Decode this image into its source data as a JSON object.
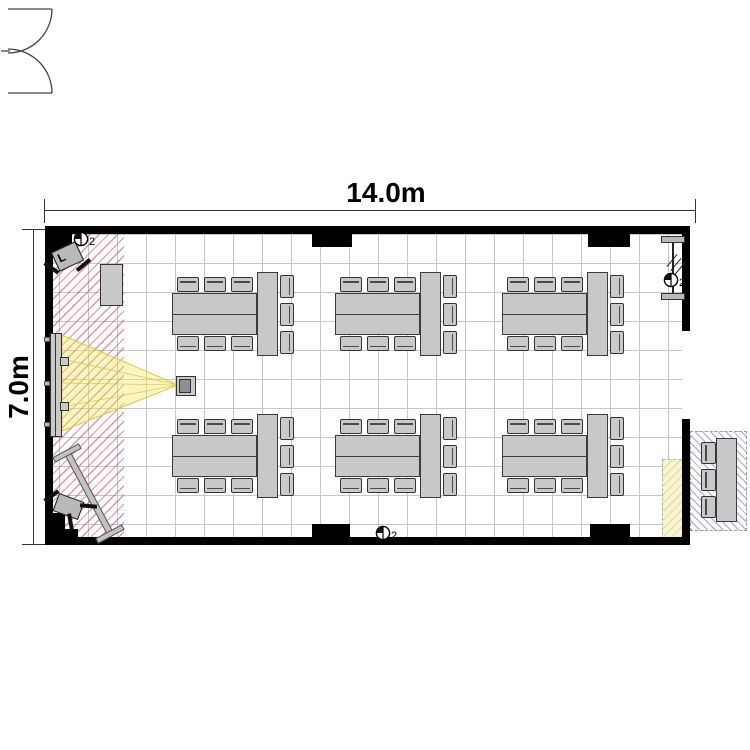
{
  "dimensions": {
    "width_label": "14.0m",
    "height_label": "7.0m"
  },
  "symbols": {
    "fixture_count_label": "2",
    "speaker_label": "L",
    "instances": [
      {
        "name": "ceiling-fixture-symbol-top-left",
        "x": 73,
        "y": 231
      },
      {
        "name": "ceiling-fixture-symbol-top-right",
        "x": 663,
        "y": 272
      },
      {
        "name": "ceiling-fixture-symbol-bottom-center",
        "x": 375,
        "y": 525
      }
    ]
  },
  "colors": {
    "wall": "#000000",
    "grid": "#c7c7c7",
    "furniture_fill": "#c8c8ca",
    "hatch_pink": "#c73e62",
    "hatch_blue": "#6e73aa",
    "beam_yellow": "#f4e45a",
    "zone_yellow": "#f7f4d4"
  },
  "plan": {
    "grid_area": {
      "x": 53,
      "y": 234,
      "w": 629,
      "h": 303
    },
    "walls": [
      {
        "name": "wall-top",
        "x": 45,
        "y": 226,
        "w": 645,
        "h": 8
      },
      {
        "name": "wall-bottom",
        "x": 45,
        "y": 537,
        "w": 645,
        "h": 8
      },
      {
        "name": "wall-left",
        "x": 45,
        "y": 226,
        "w": 8,
        "h": 319
      },
      {
        "name": "wall-right-upper",
        "x": 682,
        "y": 226,
        "w": 8,
        "h": 105
      },
      {
        "name": "wall-right-lower",
        "x": 682,
        "y": 419,
        "w": 8,
        "h": 126
      }
    ],
    "wall_blocks": [
      {
        "name": "column-top-left",
        "x": 45,
        "y": 226,
        "w": 27,
        "h": 26
      },
      {
        "name": "column-top-center",
        "x": 312,
        "y": 226,
        "w": 40,
        "h": 21
      },
      {
        "name": "column-top-right",
        "x": 588,
        "y": 226,
        "w": 42,
        "h": 21
      },
      {
        "name": "column-bottom-left-a",
        "x": 45,
        "y": 513,
        "w": 20,
        "h": 32
      },
      {
        "name": "column-bottom-left-b",
        "x": 45,
        "y": 529,
        "w": 33,
        "h": 16
      },
      {
        "name": "column-bottom-center",
        "x": 312,
        "y": 524,
        "w": 38,
        "h": 21
      },
      {
        "name": "column-bottom-right",
        "x": 590,
        "y": 524,
        "w": 40,
        "h": 21
      }
    ],
    "zones": {
      "presentation_hatch": {
        "x": 53,
        "y": 234,
        "w": 71,
        "h": 303
      },
      "equipment_yellow": {
        "x": 662,
        "y": 459,
        "w": 23,
        "h": 84
      },
      "outside_hatch": {
        "x": 690,
        "y": 431,
        "w": 55,
        "h": 98
      }
    },
    "table_geometry": {
      "main_w": 85,
      "main_h": 42,
      "end_w": 21,
      "end_h": 84,
      "chair_w": 22,
      "chair_h": 15,
      "chair_xs": [
        5,
        32,
        59
      ],
      "right_chair_w": 14,
      "right_chair_h": 23,
      "right_chair_dys": [
        -18,
        10,
        38
      ],
      "right_chair_dx": 108
    },
    "table_groups": [
      {
        "x": 172,
        "y": 293
      },
      {
        "x": 335,
        "y": 293
      },
      {
        "x": 502,
        "y": 293
      },
      {
        "x": 172,
        "y": 435
      },
      {
        "x": 335,
        "y": 435
      },
      {
        "x": 502,
        "y": 435
      }
    ],
    "outside_table": {
      "table": {
        "x": 716,
        "y": 438,
        "w": 21,
        "h": 84
      },
      "chair_x": 701,
      "chair_ys": [
        442,
        469,
        496
      ],
      "chair_w": 15,
      "chair_h": 22
    },
    "door": {
      "x": 682,
      "y": 325,
      "w": 64,
      "h": 102
    },
    "beam": {
      "x": 55,
      "y": 330,
      "w": 130,
      "h": 105
    },
    "fixtures": {
      "screen": {
        "x": 50,
        "y": 333,
        "w": 12,
        "h": 104
      },
      "screen_brackets": [
        {
          "x": 60,
          "y": 357
        },
        {
          "x": 60,
          "y": 402
        }
      ],
      "wall_ticks": [
        {
          "x": 44,
          "y": 337
        },
        {
          "x": 44,
          "y": 381
        },
        {
          "x": 44,
          "y": 422
        }
      ],
      "projector": {
        "x": 176,
        "y": 376,
        "w": 20,
        "h": 20
      },
      "cabinet": {
        "x": 100,
        "y": 264,
        "w": 23,
        "h": 42
      },
      "ac_unit": {
        "x": 661,
        "y": 236,
        "bar_w": 24,
        "bar_h": 7,
        "gap": 57
      },
      "whiteboard": {
        "bar": {
          "cx": 89,
          "cy": 493,
          "len": 96,
          "w": 7,
          "angle": 62
        },
        "feet": [
          {
            "cx": 67,
            "cy": 453
          },
          {
            "cx": 110,
            "cy": 534
          }
        ],
        "foot_len": 30,
        "foot_w": 6,
        "foot_angle": -28
      },
      "speaker_top": {
        "x": 54,
        "y": 246,
        "w": 27,
        "h": 21,
        "angle": -25,
        "legs": [
          {
            "cx": 51,
            "cy": 268,
            "angle": 35
          },
          {
            "cx": 83,
            "cy": 265,
            "angle": -40
          }
        ]
      },
      "speaker_bottom": {
        "x": 55,
        "y": 497,
        "w": 27,
        "h": 19,
        "angle": 20,
        "legs": [
          {
            "cx": 51,
            "cy": 496,
            "angle": -35
          },
          {
            "cx": 88,
            "cy": 506,
            "angle": 5
          },
          {
            "cx": 70,
            "cy": 522,
            "angle": 80
          }
        ]
      }
    },
    "dim_top": {
      "line": {
        "x": 45,
        "y": 210,
        "len": 651
      },
      "ticks_x": [
        44,
        695
      ],
      "label_cx": 386,
      "label_cy": 193
    },
    "dim_left": {
      "line": {
        "x": 33,
        "y": 230,
        "len": 315
      },
      "ticks_y": [
        229,
        544
      ],
      "label_cx": 19,
      "label_cy": 387
    }
  }
}
